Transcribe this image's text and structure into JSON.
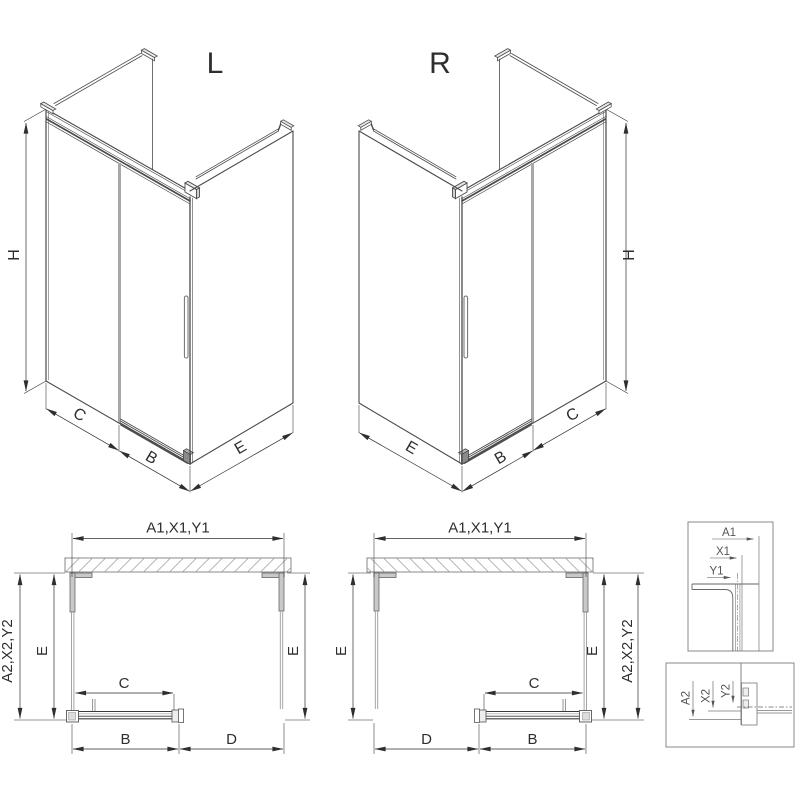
{
  "drawing": {
    "iso_left": {
      "label": "L",
      "height": "H",
      "fixed_panel": "C",
      "door": "B",
      "side_panel": "E"
    },
    "iso_right": {
      "label": "R",
      "height": "H",
      "fixed_panel": "C",
      "door": "B",
      "side_panel": "E"
    },
    "plan": {
      "width_overall": "A1,X1,Y1",
      "width_alt": "A2,X2,Y2",
      "side_depth": "E",
      "fixed_panel": "C",
      "door": "B",
      "entry": "D"
    },
    "detail_wall_profile": {
      "labels": [
        "A1",
        "X1",
        "Y1"
      ]
    },
    "detail_bottom_rail": {
      "labels": [
        "A2",
        "X2",
        "Y2"
      ]
    }
  },
  "colors": {
    "background": "#ffffff",
    "drawing_line": "#4a4a4a",
    "dimension_line": "#2e2e2e",
    "glass_line": "#9a9a9a",
    "profile_fill": "#c9c9c9",
    "detail_line": "#777777",
    "detail_text": "#555555"
  }
}
